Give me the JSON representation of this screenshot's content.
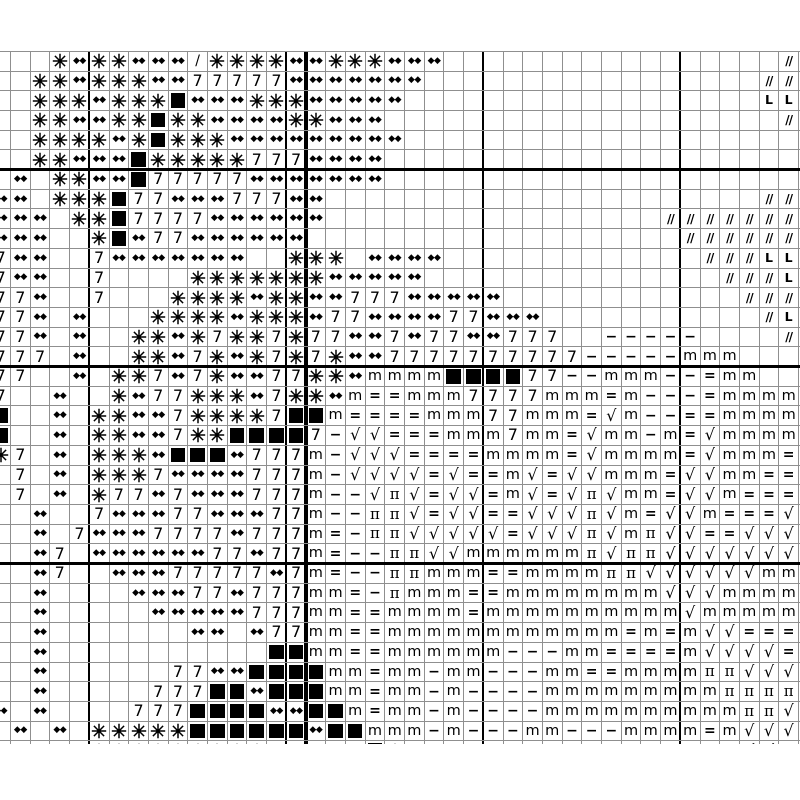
{
  "chart": {
    "title": "cross-stitch symbol chart (cropped view, no visible text labels)",
    "rows": 36,
    "cols": 41,
    "colors": {
      "background": "#ffffff",
      "grid_line": "#8f8f8f",
      "major_line": "#000000",
      "symbol": "#000000"
    },
    "major_every": 10,
    "thick_col_lines": [
      4,
      14,
      24,
      34
    ],
    "bold_col_lines": [
      15
    ],
    "thick_row_lines": [
      6,
      16,
      26
    ],
    "symbols": {
      "*": {
        "name": "eight-spoke-star-icon",
        "cls": "star",
        "glyph": ""
      },
      "d": {
        "name": "double-diamond-icon",
        "cls": "dd",
        "glyph": "◆◆"
      },
      "7": {
        "name": "digit-seven-symbol",
        "cls": "seven",
        "glyph": "7"
      },
      "F": {
        "name": "filled-square-icon",
        "cls": "sq",
        "glyph": ""
      },
      "m": {
        "name": "letter-m-symbol",
        "cls": "m",
        "glyph": "m"
      },
      "=": {
        "name": "equals-symbol",
        "cls": "eq",
        "glyph": "="
      },
      "-": {
        "name": "minus-symbol",
        "cls": "dash",
        "glyph": "−"
      },
      "v": {
        "name": "square-root-symbol",
        "cls": "root",
        "glyph": "√"
      },
      "p": {
        "name": "pi-symbol",
        "cls": "pi",
        "glyph": "π"
      },
      "s": {
        "name": "slash-symbol",
        "cls": "slash",
        "glyph": "/"
      },
      "S": {
        "name": "double-slash-symbol",
        "cls": "dslash",
        "glyph": "//"
      },
      "L": {
        "name": "letter-L-symbol",
        "cls": "ell",
        "glyph": "L"
      }
    },
    "grid_rows": [
      "...*d**ddds****dd***ddd.................S",
      "..**d***dd77777ddddddd.................SS",
      "..***d***Fddd***ddddd..................LL",
      "..**dd**F**dddd**ddd....................S",
      "..****d*F***ddddddddd....................",
      "..**dddF*****777dddd.....................",
      ".d.**ddF77777ddddddd.....................",
      "dd.***F77ddd777dd......................SS",
      "ddd.**F7777dddddd.................SSSSSSS",
      "ddd..*Fd77dddddd...................SSSSSS",
      "7dd..7ddddddd..***.dddd.............SSSLL",
      "7dd..7....*******ddddd...............SSSL",
      "77d..7...****d**dd777ddddd............SSS",
      "77d.d...****d***d77dddd77ddd...........SL",
      "77d.d..**d*7**7*77dd7d77dd777..-----....S",
      "777.d..**d7*d*7*7*dd7777777777-----mmm...",
      "77..d.**7d7*dd77**dmmmmFFFF77--mmm--=mm..",
      "7..d..*d77***d7**dm==mmm7777mmm=m---=mmmm",
      "F..d.**dd7****7FFm====mmm77mmm=vm--==mmmm",
      "F..d.**dd7**FFFF7-vv===mmm7mm=vmm-m=vmmmm",
      "*7.d.***dFFFd777m-vvv====mmmm=vmmmm=vmmm=",
      ".7.d.***7dddd777m-vvvv=v==mv=vvmmm=vvmm==",
      ".7.d.*77d7ddd777m--vpv=vv=mv=vpvmm=vvm===",
      "..d..7ddd77ddd77m--ppv=vv==vvvpvm=vvm===v",
      "..d.7ddd7777d777m=-ppvvvvv=vvvpvmpvv==vvv",
      "..d7.dddddd77d77m=--ppvvmmmmmmpvppvvvvvvv",
      "..d7..ddd77777d7m=--ppmmm==mmmmppvvvvvvmm",
      "..d....ddd77d777mm=-pmmm==mmmmmmmmvvvmmmm",
      "..d.....ddddd777mm==mmmm=mmmmmmmmmmvmmmmm",
      "..d.......dd.d77mm==mmmmmmmmmmmm=m=mvv===",
      "..d...........FFmm==mmmmmm---mm====mvvvv=",
      "..d......77ddFFFFmm=mm-mm---mm==mmmmppvvv",
      "..d.....777FFdFFFmm=mm-m----mmmmmmmmmpppp",
      "d.d....777FFFFddFFm=mm-m----mmmmmmmmmmppv",
      ".d.d.*****FFFFFFdFFmmm-m---mm---mmmm=mvvv",
      "..dd.*********77777F*m....m.....mmm==mvv-"
    ]
  }
}
